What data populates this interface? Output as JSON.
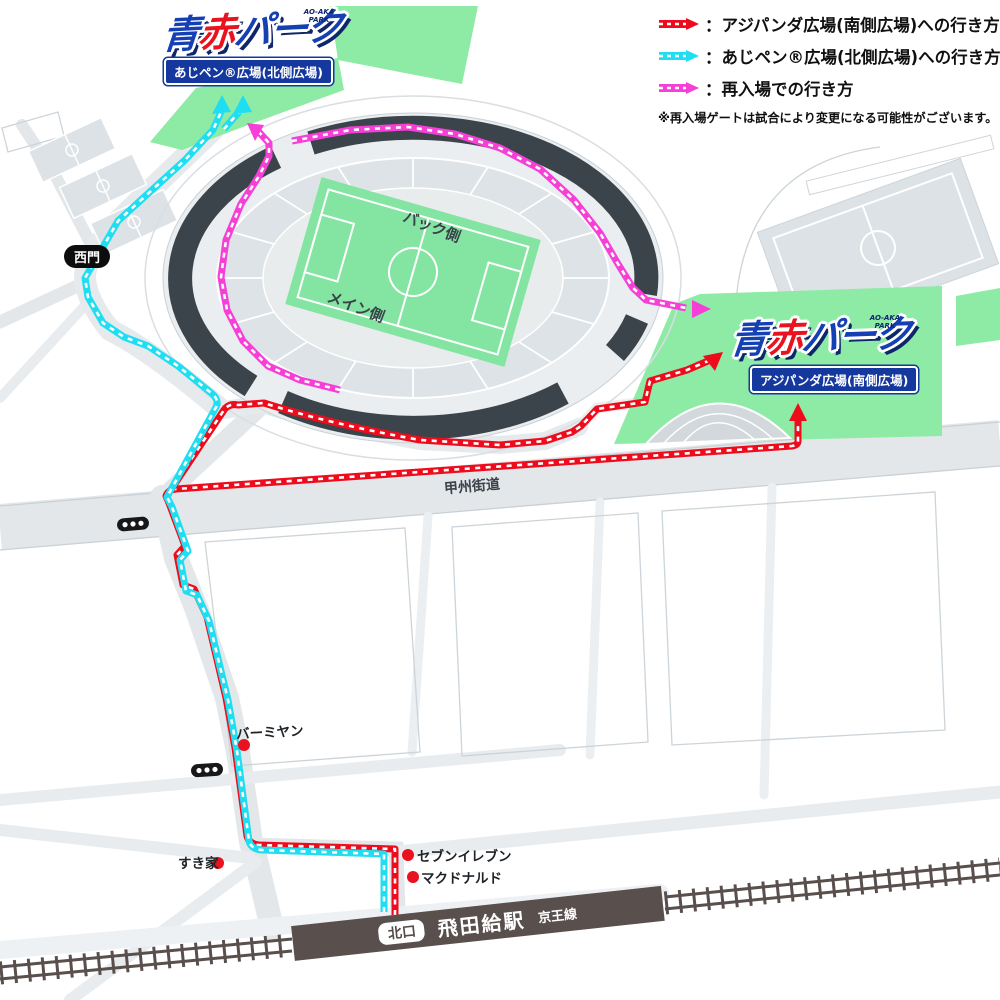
{
  "legend": {
    "items": [
      {
        "icon": "red-dashed-arrow",
        "color": "#ee0c1c",
        "label": "：アジパンダ広場(南側広場)への行き方"
      },
      {
        "icon": "cyan-dashed-arrow",
        "color": "#1fdef2",
        "label": "：あじペン®広場(北側広場)への行き方"
      },
      {
        "icon": "magenta-dashed-arrow",
        "color": "#f63fd7",
        "label": "：再入場での行き方"
      }
    ],
    "note": "※再入場ゲートは試合により変更になる可能性がございます。"
  },
  "north_park": {
    "logo_ao": "青",
    "logo_aka": "赤",
    "logo_park": "パーク",
    "logo_sub": "AO-AKA PARK",
    "label": "あじペン®広場(北側広場)"
  },
  "south_park": {
    "logo_ao": "青",
    "logo_aka": "赤",
    "logo_park": "パーク",
    "logo_sub": "AO-AKA PARK",
    "label": "アジパンダ広場(南側広場)"
  },
  "stadium": {
    "back_stand": "バック側",
    "main_stand": "メイン側"
  },
  "gates": {
    "west_gate": "西門"
  },
  "roads": {
    "koshu_kaido": "甲州街道"
  },
  "landmarks": [
    {
      "name": "バーミヤン"
    },
    {
      "name": "すき家"
    },
    {
      "name": "セブンイレブン"
    },
    {
      "name": "マクドナルド"
    }
  ],
  "station": {
    "exit": "北口",
    "name": "飛田給駅",
    "line": "京王線"
  },
  "colors": {
    "route_south_red": "#ee0c1c",
    "route_north_cyan": "#1fdef2",
    "route_reentry_magenta": "#f63fd7",
    "pitch_green": "#83e5a1",
    "plaza_green": "#8deba5",
    "stadium_dark": "#3c444b",
    "railway_brown": "#594f4d",
    "label_blue": "#15389e"
  }
}
